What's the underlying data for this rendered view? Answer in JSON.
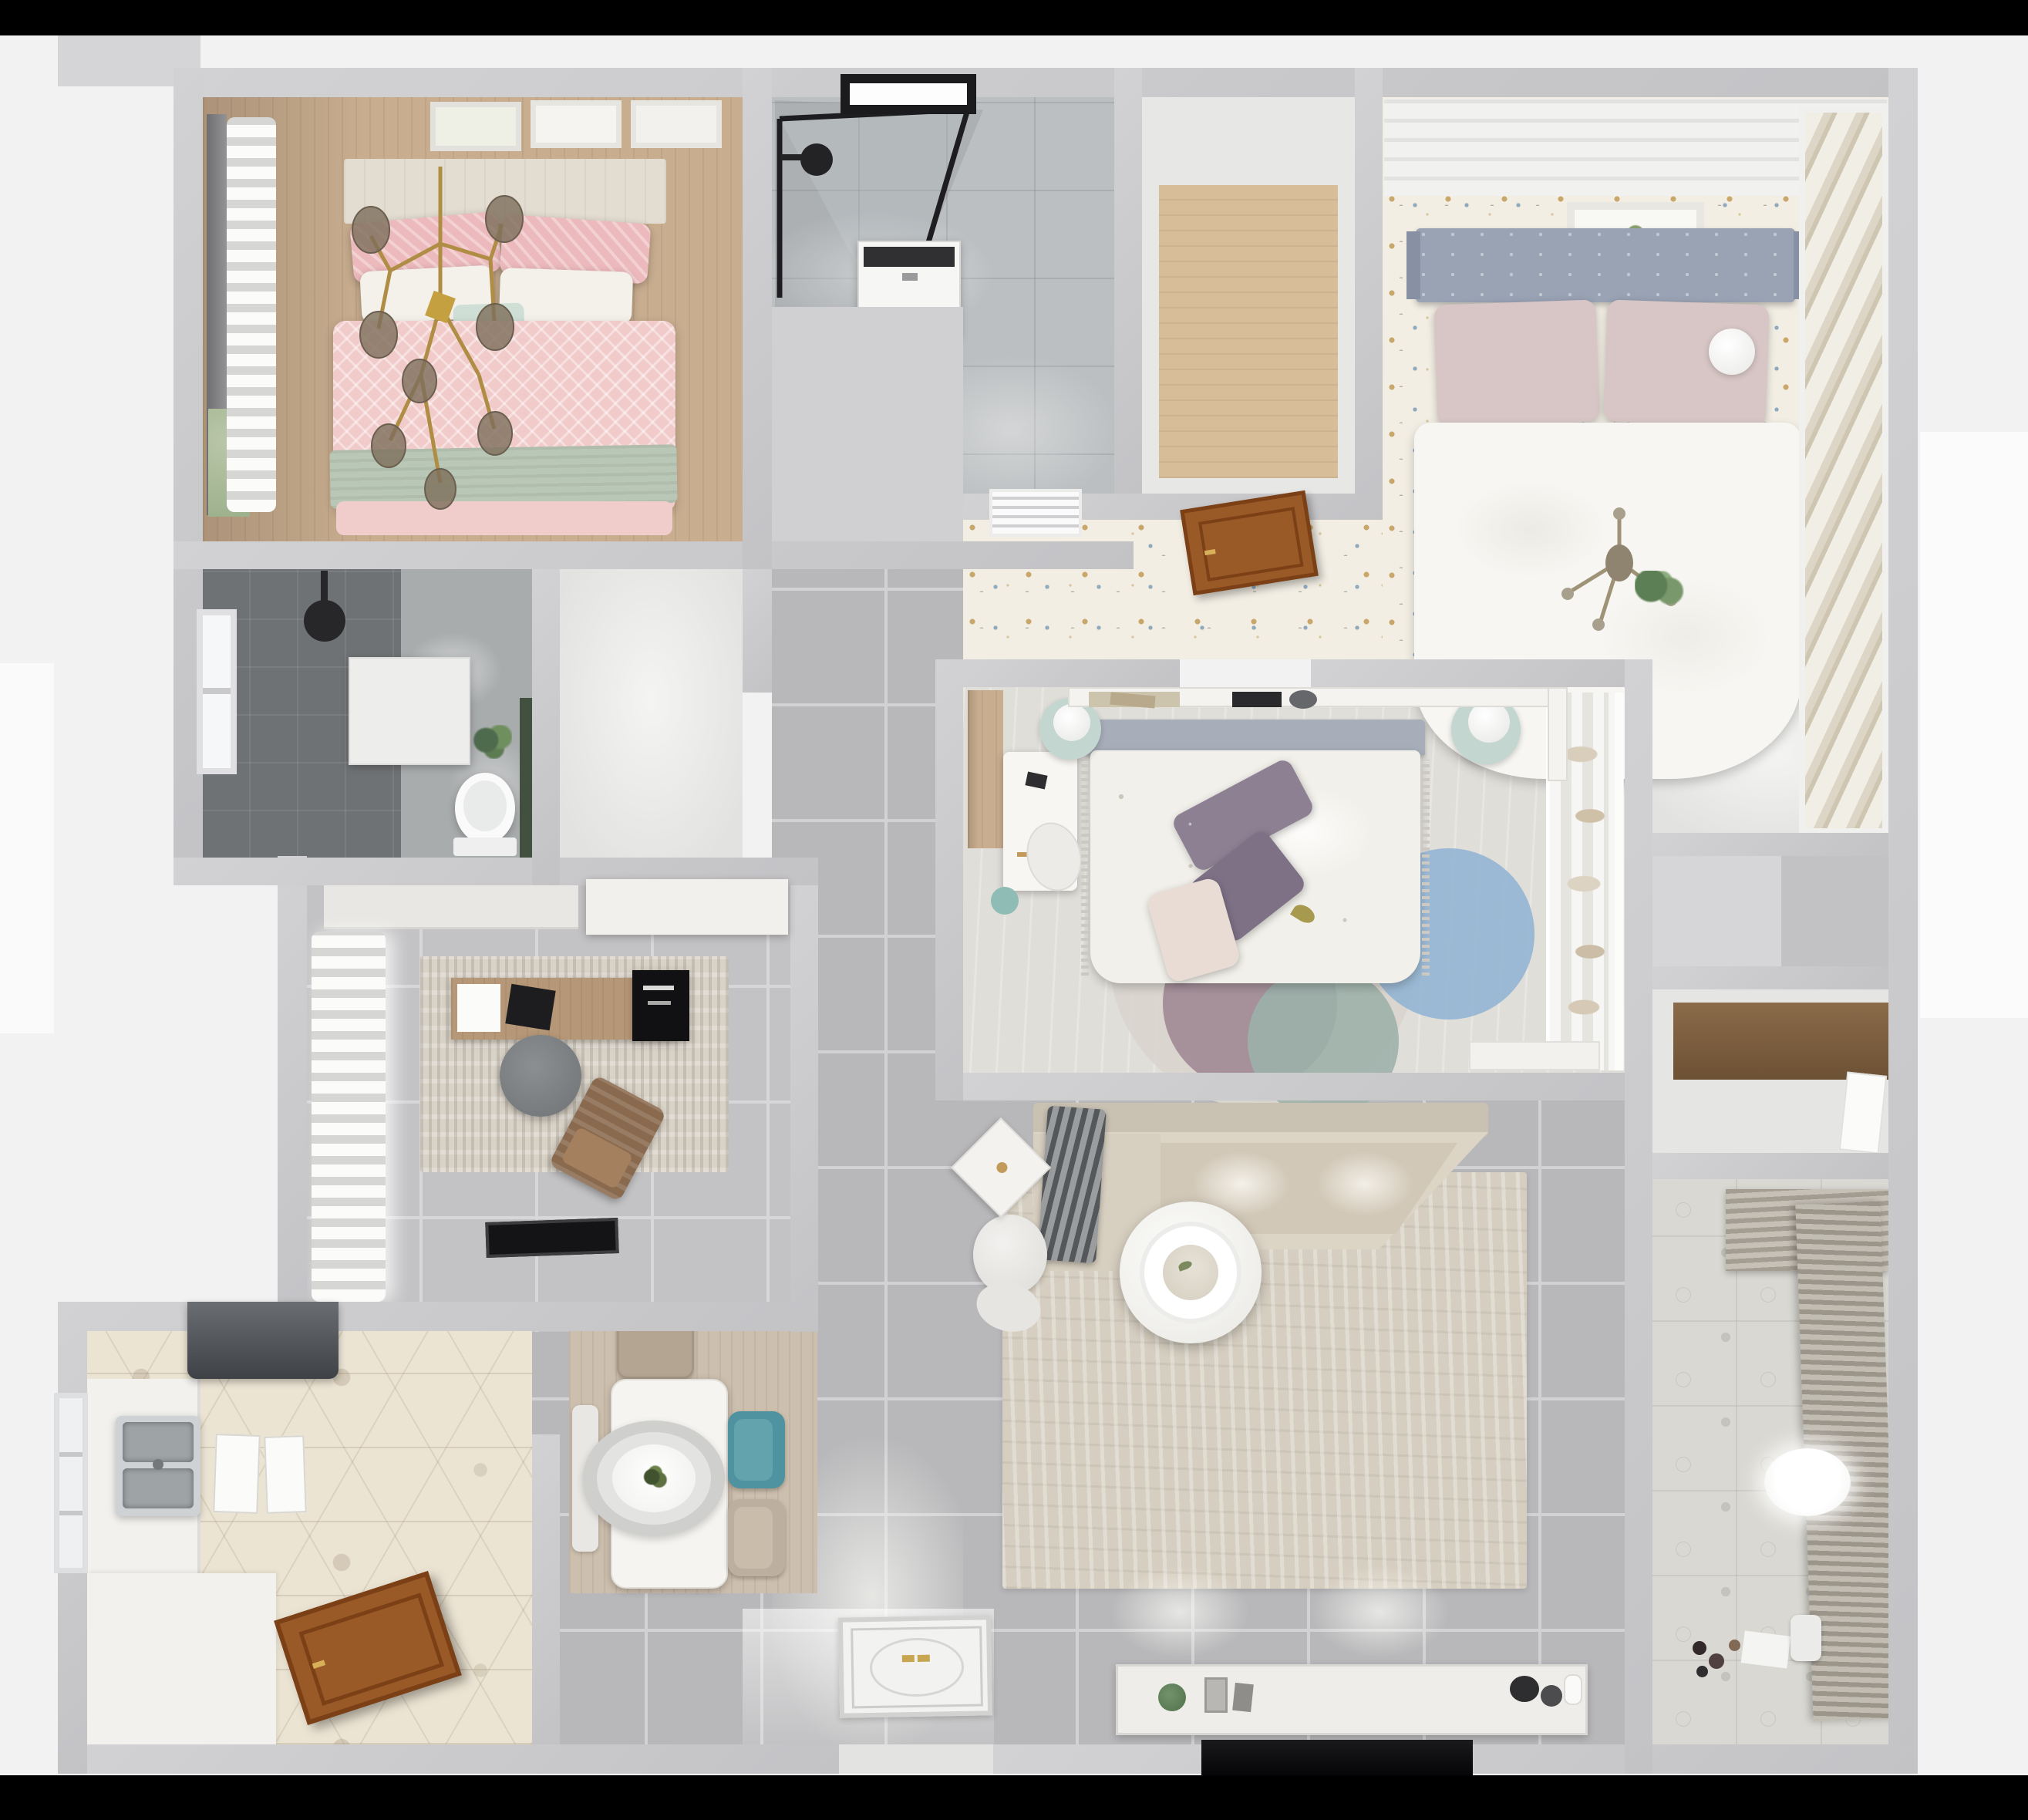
{
  "scene": {
    "kind": "3d-rendered-floor-plan",
    "view": "top-down dollhouse",
    "visible_text": "none",
    "background": {
      "top_bar_color": "#000000",
      "bottom_bar_color": "#000000",
      "page_color": "#f2f2f2"
    }
  },
  "palette": {
    "wall": "#c9c9cb",
    "gray_tile": "#b8b8ba",
    "light_tile": "#c3c3c5",
    "wood": "#c8ad8f",
    "speckle_floor": "#f2eee4",
    "hex_tile": "#ece4d3",
    "dark_bath_tile": "#6f7274",
    "marble": "#bcbfc1",
    "pink_duvet": "#f1cbca",
    "sage_throw": "#b9c7b6",
    "gold": "#b08d45",
    "gray_headboard": "#99a3b4",
    "white_duvet": "#f7f6f2",
    "purple_pillow": "#8d8093",
    "blue_rug": "#93b5d3",
    "mauve_rug": "#a08a95",
    "tealgray_rug": "#9cb0aa",
    "teal_chair": "#4f93a0",
    "beige_sofa": "#dcd4c5",
    "rug_beige": "#d6cec0",
    "door_wood": "#9a5a28",
    "tv_black": "#0b0b0d",
    "mint_nightstand": "#c3d6cf"
  },
  "rooms": [
    {
      "id": "master-bedroom",
      "name": "Master bedroom (top-left)",
      "floor": "wood planks",
      "items": [
        "double bed with pink patterned duvet",
        "sage green throw",
        "pink and white pillows",
        "gold branch chandelier with glass globes",
        "dark window curtain",
        "sheer curtain",
        "three wall art frames",
        "headboard cabinet"
      ]
    },
    {
      "id": "bathroom-main",
      "name": "Main bathroom (top-center)",
      "floor": "light marble tile",
      "items": [
        "black framed glass shower",
        "black shower head",
        "black window",
        "washing machine",
        "toilet"
      ]
    },
    {
      "id": "closet-hall",
      "name": "Closet / storage (top-center-right)",
      "floor": "wood planks",
      "items": [
        "empty wardrobe room",
        "AC vent grille on lower wall"
      ]
    },
    {
      "id": "guest-bedroom",
      "name": "Bedroom (top-right)",
      "floor": "confetti speckled tile",
      "items": [
        "bed with gray tufted headboard",
        "blush pillows",
        "white duvet",
        "white ball lamp",
        "gold sprig decor",
        "art frame",
        "striped sliding-door wardrobe",
        "open wooden door",
        "plant on ledge"
      ]
    },
    {
      "id": "bathroom-second",
      "name": "Second bathroom (middle-left)",
      "floor": "dark gray tile",
      "items": [
        "window",
        "black shower head",
        "wall cabinet",
        "toilet",
        "green accent wall",
        "plant"
      ]
    },
    {
      "id": "inner-hall",
      "name": "Hallway nook",
      "floor": "bright white floor",
      "items": []
    },
    {
      "id": "study",
      "name": "Study (middle-left)",
      "floor": "gray tile",
      "items": [
        "sheer curtains",
        "distressed rug",
        "wooden desk",
        "monitor",
        "laptop",
        "gray round office chair",
        "brown lounge chair",
        "black doormat",
        "white cabinets"
      ]
    },
    {
      "id": "kids-bedroom",
      "name": "Bedroom (center)",
      "floor": "light wood",
      "items": [
        "bed with floral duvet",
        "purple pillows",
        "headboard shelf with books",
        "white desk and chair",
        "two mint round nightstands with lamps",
        "round rug with blue, mauve and teal circles",
        "open wardrobe with clothes",
        "sheer curtain",
        "wood wardrobe strip",
        "teal kettle"
      ]
    },
    {
      "id": "living-room",
      "name": "Living room (center-bottom)",
      "floor": "gray tile",
      "items": [
        "beige sectional sofa",
        "gray striped blanket",
        "beige area rug",
        "round white coffee table",
        "white pouf",
        "rotated side table",
        "TV console with decor",
        "wall TV",
        "front door with ornate panel",
        "ceiling light reflections"
      ]
    },
    {
      "id": "dining",
      "name": "Dining area (bottom-center)",
      "floor": "gray tile with wood mat",
      "items": [
        "white dining table",
        "oval pendant lamp",
        "green centerpiece plant",
        "taupe chair",
        "teal chair",
        "beige chair",
        "bench"
      ]
    },
    {
      "id": "kitchen",
      "name": "Kitchen (bottom-left)",
      "floor": "hexagon patterned tile",
      "items": [
        "range hood",
        "L-shaped white counter",
        "double stainless sink",
        "two white trays",
        "window",
        "open wooden door"
      ]
    },
    {
      "id": "balcony",
      "name": "Balcony / utility (bottom-right)",
      "floor": "patterned tile",
      "items": [
        "roller blinds",
        "oval ceiling light",
        "toys on floor",
        "paper sheets",
        "white roll"
      ]
    },
    {
      "id": "right-hall",
      "name": "Right-side halls and niches",
      "floor": "white / gray",
      "items": [
        "closet niche",
        "wooden shelf niche",
        "white door"
      ]
    }
  ]
}
